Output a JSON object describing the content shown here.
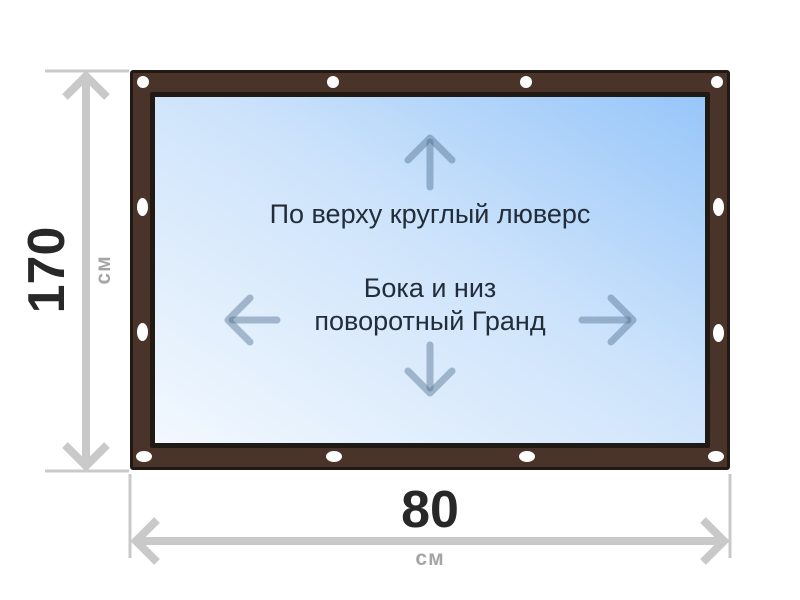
{
  "diagram": {
    "type": "tarpaulin-size-diagram",
    "notes": {
      "top": "По верху круглый люверс",
      "middle_line1": "Бока и низ",
      "middle_line2": "поворотный Гранд"
    },
    "dimensions": {
      "height": {
        "value": "170",
        "unit": "см"
      },
      "width": {
        "value": "80",
        "unit": "см"
      }
    },
    "grommets": {
      "top_count": 4,
      "bottom_count": 4,
      "left_count": 2,
      "right_count": 2
    },
    "arrow_icons": [
      "arrow-up-icon",
      "arrow-left-icon",
      "arrow-right-icon",
      "arrow-down-icon"
    ]
  },
  "colors": {
    "frame_brown": "#4a3329",
    "frame_outline": "#211a14",
    "screen_light": "#f2f8fe",
    "screen_blue": "#97c6f9",
    "grommet_white": "#ffffff",
    "arrow_blue": "rgba(75, 105, 135, 0.42)",
    "dim_gray": "#c9c9c9",
    "number_dark": "#282828",
    "unit_gray": "#a5a5a5",
    "note_dark": "#222d39"
  }
}
